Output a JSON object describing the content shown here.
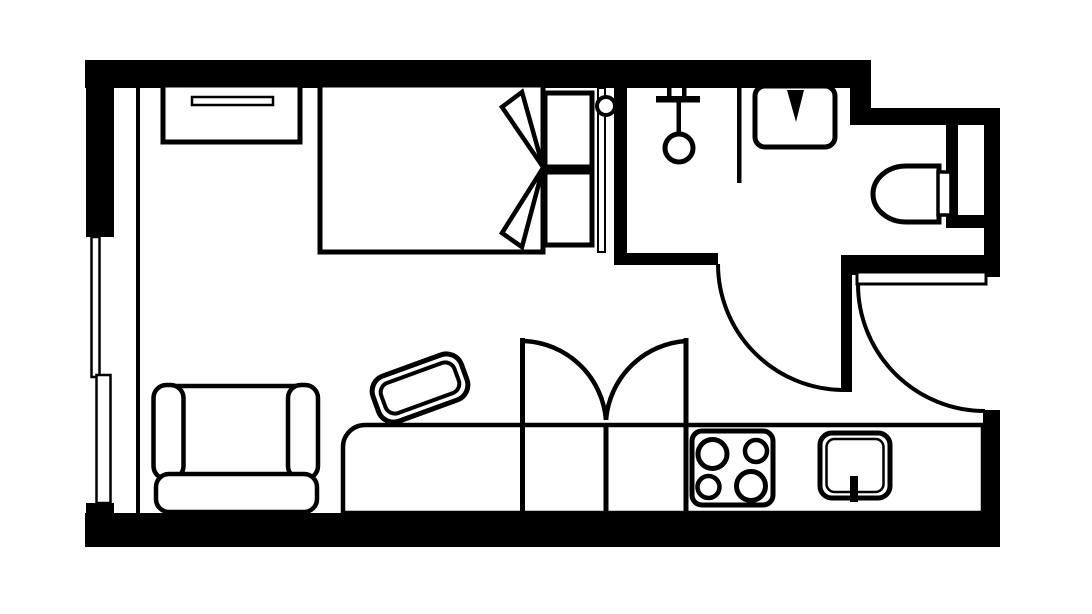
{
  "meta": {
    "title": "Studio Apartment Floor Plan",
    "kind": "floor-plan",
    "rooms_depicted": [
      "bedroom",
      "bathroom",
      "entry-hall",
      "living-area",
      "kitchen"
    ]
  },
  "canvas": {
    "width": 1092,
    "height": 614,
    "background_color": "#ffffff",
    "line_color": "#000000"
  },
  "shapes": [
    {
      "name": "background",
      "kind": "rect",
      "attrs": {
        "x": 0,
        "y": 0,
        "width": 1092,
        "height": 614,
        "fill": "#ffffff"
      }
    },
    {
      "name": "wall-top",
      "kind": "rect",
      "attrs": {
        "x": 85,
        "y": 60,
        "width": 786,
        "height": 28,
        "fill": "#000000"
      }
    },
    {
      "name": "wall-top-step",
      "kind": "rect",
      "attrs": {
        "x": 850,
        "y": 88,
        "width": 21,
        "height": 37,
        "fill": "#000000"
      }
    },
    {
      "name": "wall-bathroom-top",
      "kind": "rect",
      "attrs": {
        "x": 864,
        "y": 108,
        "width": 136,
        "height": 17,
        "fill": "#000000"
      }
    },
    {
      "name": "wall-left-upper",
      "kind": "rect",
      "attrs": {
        "x": 86,
        "y": 60,
        "width": 28,
        "height": 177,
        "fill": "#000000"
      }
    },
    {
      "name": "wall-left-sill-stub",
      "kind": "rect",
      "attrs": {
        "x": 86,
        "y": 503,
        "width": 28,
        "height": 14,
        "fill": "#000000"
      }
    },
    {
      "name": "wall-bottom",
      "kind": "rect",
      "attrs": {
        "x": 85,
        "y": 513,
        "width": 915,
        "height": 34,
        "fill": "#000000"
      }
    },
    {
      "name": "wall-right-bathroom",
      "kind": "rect",
      "attrs": {
        "x": 984,
        "y": 108,
        "width": 16,
        "height": 169,
        "fill": "#000000"
      }
    },
    {
      "name": "wall-right-kitchen",
      "kind": "rect",
      "attrs": {
        "x": 983,
        "y": 410,
        "width": 17,
        "height": 137,
        "fill": "#000000"
      }
    },
    {
      "name": "wall-bedroom-bathroom-divider",
      "kind": "rect",
      "attrs": {
        "x": 614,
        "y": 88,
        "width": 13,
        "height": 177,
        "fill": "#000000"
      }
    },
    {
      "name": "wall-bathroom-south-left",
      "kind": "rect",
      "attrs": {
        "x": 614,
        "y": 253,
        "width": 104,
        "height": 12,
        "fill": "#000000"
      }
    },
    {
      "name": "wall-bathroom-south-right",
      "kind": "rect",
      "attrs": {
        "x": 843,
        "y": 255,
        "width": 157,
        "height": 20,
        "fill": "#000000"
      }
    },
    {
      "name": "wall-toilet-side-stub",
      "kind": "rect",
      "attrs": {
        "x": 946,
        "y": 125,
        "width": 12,
        "height": 91,
        "fill": "#000000"
      }
    },
    {
      "name": "window-right-mullion",
      "kind": "rect",
      "attrs": {
        "x": 946,
        "y": 215,
        "width": 39,
        "height": 13,
        "fill": "#000000"
      }
    },
    {
      "name": "window-left-upper-pane",
      "kind": "rect",
      "attrs": {
        "x": 91.5,
        "y": 237,
        "width": 8,
        "height": 140,
        "fill": "#ffffff",
        "stroke": "#000000",
        "stroke-width": 2.5
      }
    },
    {
      "name": "window-left-lower-pane",
      "kind": "rect",
      "attrs": {
        "x": 96.5,
        "y": 375,
        "width": 14,
        "height": 128,
        "fill": "#ffffff",
        "stroke": "#000000",
        "stroke-width": 2.5
      }
    },
    {
      "name": "interior-wall-line-left",
      "kind": "rect",
      "attrs": {
        "x": 136,
        "y": 88,
        "width": 4,
        "height": 425,
        "fill": "#000000"
      }
    },
    {
      "name": "dresser",
      "kind": "rect",
      "attrs": {
        "x": 163,
        "y": 85,
        "width": 137,
        "height": 57,
        "fill": "#ffffff",
        "stroke": "#000000",
        "stroke-width": 5
      }
    },
    {
      "name": "dresser-handle",
      "kind": "rect",
      "attrs": {
        "x": 192,
        "y": 97,
        "width": 81,
        "height": 8,
        "fill": "#ffffff",
        "stroke": "#000000",
        "stroke-width": 2.5
      }
    },
    {
      "name": "bed",
      "kind": "rect",
      "attrs": {
        "x": 320,
        "y": 85,
        "width": 223,
        "height": 167,
        "fill": "#ffffff",
        "stroke": "#000000",
        "stroke-width": 5
      }
    },
    {
      "name": "blanket-fold-upper",
      "kind": "polygon",
      "attrs": {
        "points": "522,92 502,107 543,167",
        "fill": "#ffffff",
        "stroke": "#000000",
        "stroke-width": 4.5
      }
    },
    {
      "name": "blanket-fold-lower",
      "kind": "polygon",
      "attrs": {
        "points": "502,233 522,247 543,168",
        "fill": "#ffffff",
        "stroke": "#000000",
        "stroke-width": 4.5
      }
    },
    {
      "name": "pillow-upper",
      "kind": "rect",
      "attrs": {
        "x": 545,
        "y": 93,
        "width": 47,
        "height": 74,
        "fill": "#ffffff",
        "stroke": "#000000",
        "stroke-width": 5
      }
    },
    {
      "name": "pillow-lower",
      "kind": "rect",
      "attrs": {
        "x": 545,
        "y": 172,
        "width": 47,
        "height": 73,
        "fill": "#ffffff",
        "stroke": "#000000",
        "stroke-width": 5
      }
    },
    {
      "name": "bed-headboard-line",
      "kind": "rect",
      "attrs": {
        "x": 598,
        "y": 88,
        "width": 7,
        "height": 164,
        "fill": "#ffffff",
        "stroke": "#000000",
        "stroke-width": 2
      }
    },
    {
      "name": "bed-knob",
      "kind": "circle",
      "attrs": {
        "cx": 606,
        "cy": 106,
        "r": 9,
        "fill": "#ffffff",
        "stroke": "#000000",
        "stroke-width": 4
      }
    },
    {
      "name": "shower-arm-tick-left",
      "kind": "rect",
      "attrs": {
        "x": 667,
        "y": 88,
        "width": 4.5,
        "height": 10,
        "fill": "#000000"
      }
    },
    {
      "name": "shower-arm-tick-right",
      "kind": "rect",
      "attrs": {
        "x": 682,
        "y": 88,
        "width": 4.5,
        "height": 10,
        "fill": "#000000"
      }
    },
    {
      "name": "shower-arm-bar",
      "kind": "rect",
      "attrs": {
        "x": 656,
        "y": 96,
        "width": 44,
        "height": 6.5,
        "fill": "#000000"
      }
    },
    {
      "name": "shower-hose",
      "kind": "rect",
      "attrs": {
        "x": 676.5,
        "y": 102,
        "width": 4.5,
        "height": 33,
        "fill": "#000000"
      }
    },
    {
      "name": "shower-head",
      "kind": "circle",
      "attrs": {
        "cx": 679,
        "cy": 148,
        "r": 14,
        "fill": "#ffffff",
        "stroke": "#000000",
        "stroke-width": 5
      }
    },
    {
      "name": "shower-partition-line",
      "kind": "rect",
      "attrs": {
        "x": 737,
        "y": 88,
        "width": 4.5,
        "height": 95,
        "fill": "#000000"
      }
    },
    {
      "name": "vanity-sink",
      "kind": "rect",
      "attrs": {
        "x": 755,
        "y": 86,
        "width": 80,
        "height": 61,
        "rx": 10,
        "fill": "#ffffff",
        "stroke": "#000000",
        "stroke-width": 5
      }
    },
    {
      "name": "vanity-faucet",
      "kind": "polygon",
      "attrs": {
        "points": "787,90 804,90 796,122",
        "fill": "#000000"
      }
    },
    {
      "name": "toilet-bowl",
      "kind": "path",
      "attrs": {
        "d": "M 939 166 L 906 166 A 33 28 0 0 0 906 222 L 939 222 Z",
        "fill": "#ffffff",
        "stroke": "#000000",
        "stroke-width": 5
      }
    },
    {
      "name": "toilet-tank",
      "kind": "rect",
      "attrs": {
        "x": 938,
        "y": 172,
        "width": 13,
        "height": 43,
        "fill": "#ffffff",
        "stroke": "#000000",
        "stroke-width": 3.5
      }
    },
    {
      "name": "bathroom-door-leaf",
      "kind": "rect",
      "attrs": {
        "x": 841,
        "y": 255,
        "width": 11,
        "height": 137,
        "fill": "#000000"
      }
    },
    {
      "name": "bathroom-door-swing",
      "kind": "path",
      "attrs": {
        "d": "M 718 264 A 126 126 0 0 0 842 390",
        "fill": "none",
        "stroke": "#000000",
        "stroke-width": 4
      }
    },
    {
      "name": "entry-door-leaf",
      "kind": "rect",
      "attrs": {
        "x": 857,
        "y": 272,
        "width": 129,
        "height": 12,
        "fill": "#ffffff",
        "stroke": "#000000",
        "stroke-width": 3
      }
    },
    {
      "name": "entry-door-swing",
      "kind": "path",
      "attrs": {
        "d": "M 858 284 A 127 127 0 0 0 985 411",
        "fill": "none",
        "stroke": "#000000",
        "stroke-width": 4
      }
    },
    {
      "name": "desk-chair-outer",
      "kind": "rect",
      "attrs": {
        "x": -47,
        "y": -24,
        "width": 94,
        "height": 48,
        "rx": 16,
        "transform": "translate(420,388) rotate(-20)",
        "fill": "#ffffff",
        "stroke": "#000000",
        "stroke-width": 5
      }
    },
    {
      "name": "desk-chair-inner",
      "kind": "rect",
      "attrs": {
        "x": -39,
        "y": -16,
        "width": 78,
        "height": 32,
        "rx": 10,
        "transform": "translate(420,388) rotate(-20)",
        "fill": "none",
        "stroke": "#000000",
        "stroke-width": 4
      }
    },
    {
      "name": "bench-counter-band",
      "kind": "path",
      "attrs": {
        "d": "M 365 425 H 983 V 513 H 343 V 447 A 22 22 0 0 1 365 425 Z",
        "fill": "#ffffff",
        "stroke": "#000000",
        "stroke-width": 4.5
      }
    },
    {
      "name": "wardrobe-jamb-left",
      "kind": "rect",
      "attrs": {
        "x": 520,
        "y": 338,
        "width": 5,
        "height": 175,
        "fill": "#000000"
      }
    },
    {
      "name": "wardrobe-divider-mid",
      "kind": "rect",
      "attrs": {
        "x": 603.5,
        "y": 427,
        "width": 5,
        "height": 86,
        "fill": "#000000"
      }
    },
    {
      "name": "wardrobe-jamb-right",
      "kind": "rect",
      "attrs": {
        "x": 683.5,
        "y": 338,
        "width": 5,
        "height": 175,
        "fill": "#000000"
      }
    },
    {
      "name": "wardrobe-door-swing-left",
      "kind": "path",
      "attrs": {
        "d": "M 524.5 341 A 86 86 0 0 1 606 420",
        "fill": "none",
        "stroke": "#000000",
        "stroke-width": 4.5
      }
    },
    {
      "name": "wardrobe-door-swing-right",
      "kind": "path",
      "attrs": {
        "d": "M 686 341 A 86 86 0 0 0 606 420",
        "fill": "none",
        "stroke": "#000000",
        "stroke-width": 4.5
      }
    },
    {
      "name": "stove",
      "kind": "rect",
      "attrs": {
        "x": 692,
        "y": 431,
        "width": 81,
        "height": 74,
        "rx": 10,
        "fill": "#ffffff",
        "stroke": "#000000",
        "stroke-width": 5
      }
    },
    {
      "name": "burner-large-top-left",
      "kind": "circle",
      "attrs": {
        "cx": 712.5,
        "cy": 454,
        "r": 14.5,
        "fill": "#ffffff",
        "stroke": "#000000",
        "stroke-width": 5
      }
    },
    {
      "name": "burner-small-top-right",
      "kind": "circle",
      "attrs": {
        "cx": 756,
        "cy": 451,
        "r": 11,
        "fill": "#ffffff",
        "stroke": "#000000",
        "stroke-width": 4.5
      }
    },
    {
      "name": "burner-small-bottom-left",
      "kind": "circle",
      "attrs": {
        "cx": 708.5,
        "cy": 487,
        "r": 11,
        "fill": "#ffffff",
        "stroke": "#000000",
        "stroke-width": 4.5
      }
    },
    {
      "name": "burner-large-bottom-right",
      "kind": "circle",
      "attrs": {
        "cx": 751,
        "cy": 486,
        "r": 14.5,
        "fill": "#ffffff",
        "stroke": "#000000",
        "stroke-width": 5
      }
    },
    {
      "name": "kitchen-sink-outer",
      "kind": "rect",
      "attrs": {
        "x": 820,
        "y": 433,
        "width": 70,
        "height": 65,
        "rx": 12,
        "fill": "#ffffff",
        "stroke": "#000000",
        "stroke-width": 5
      }
    },
    {
      "name": "kitchen-sink-inner",
      "kind": "rect",
      "attrs": {
        "x": 826.5,
        "y": 439,
        "width": 57,
        "height": 53,
        "rx": 8,
        "fill": "none",
        "stroke": "#000000",
        "stroke-width": 2.5
      }
    },
    {
      "name": "kitchen-faucet",
      "kind": "rect",
      "attrs": {
        "x": 850,
        "y": 476,
        "width": 8,
        "height": 26,
        "fill": "#000000"
      }
    },
    {
      "name": "armchair-seat",
      "kind": "rect",
      "attrs": {
        "x": 168,
        "y": 386,
        "width": 134,
        "height": 92,
        "fill": "#ffffff",
        "stroke": "#000000",
        "stroke-width": 4.5
      }
    },
    {
      "name": "armchair-arm-left",
      "kind": "rect",
      "attrs": {
        "x": 153.5,
        "y": 385,
        "width": 30,
        "height": 94,
        "rx": 13,
        "fill": "#ffffff",
        "stroke": "#000000",
        "stroke-width": 4.5
      }
    },
    {
      "name": "armchair-arm-right",
      "kind": "rect",
      "attrs": {
        "x": 288,
        "y": 385,
        "width": 30,
        "height": 94,
        "rx": 13,
        "fill": "#ffffff",
        "stroke": "#000000",
        "stroke-width": 4.5
      }
    },
    {
      "name": "armchair-back",
      "kind": "rect",
      "attrs": {
        "x": 156,
        "y": 474,
        "width": 161,
        "height": 38,
        "rx": 13,
        "fill": "#ffffff",
        "stroke": "#000000",
        "stroke-width": 4.5
      }
    }
  ]
}
